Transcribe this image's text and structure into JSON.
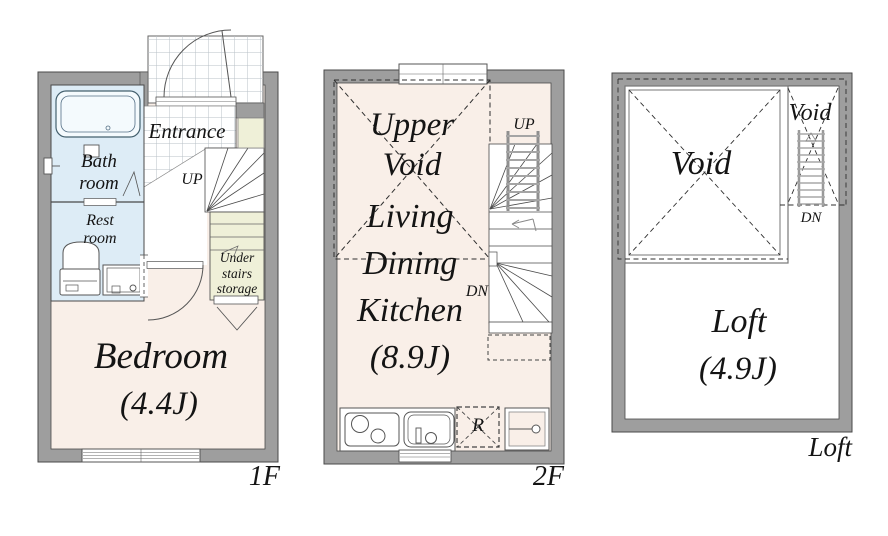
{
  "colors": {
    "wall_gray": "#9e9e9e",
    "floor_beige": "#f9efe8",
    "bathroom_blue": "#ddecf6",
    "storage_yellow": "#eff0d8",
    "loft_white": "#ffffff",
    "line": "#4a4a4a"
  },
  "plans": {
    "f1": {
      "floor_label": "1F",
      "entrance": "Entrance",
      "up": "UP",
      "bath_line1": "Bath",
      "bath_line2": "room",
      "rest_line1": "Rest",
      "rest_line2": "room",
      "storage_line1": "Under",
      "storage_line2": "stairs",
      "storage_line3": "storage",
      "room_name": "Bedroom",
      "room_size": "(4.4J)"
    },
    "f2": {
      "floor_label": "2F",
      "void_line1": "Upper",
      "void_line2": "Void",
      "room_line1": "Living",
      "room_line2": "Dining",
      "room_line3": "Kitchen",
      "room_line4": "(8.9J)",
      "up": "UP",
      "dn": "DN",
      "refrigerator": "R"
    },
    "loft": {
      "floor_label": "Loft",
      "void_large": "Void",
      "void_small": "Void",
      "room_name": "Loft",
      "room_size": "(4.9J)",
      "dn": "DN"
    }
  }
}
